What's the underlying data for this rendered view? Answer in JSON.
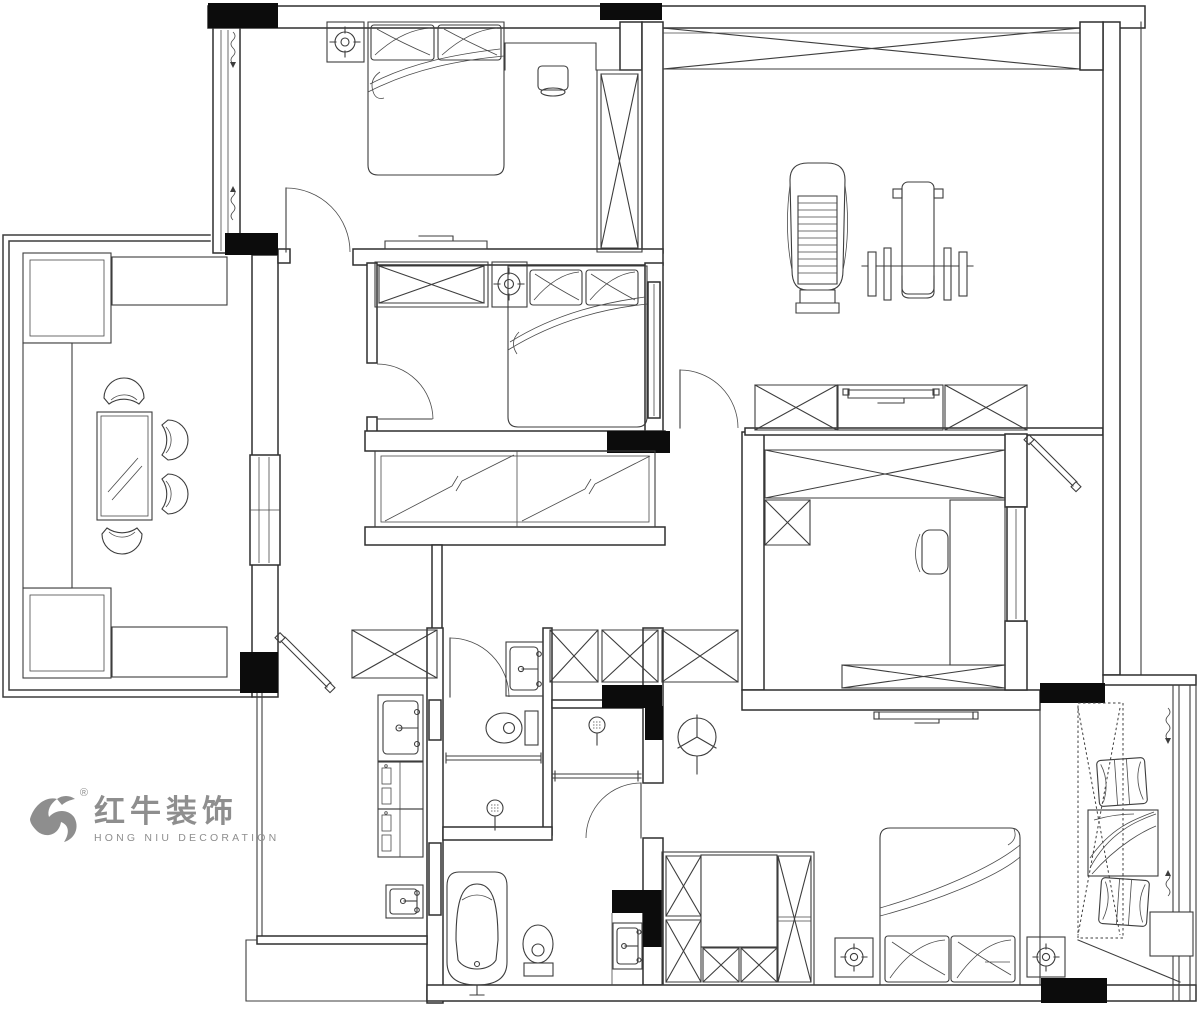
{
  "page": {
    "background": "#ffffff",
    "canvas_width": 1200,
    "canvas_height": 1009
  },
  "colors": {
    "line": "#3d3d3d",
    "wall": "#2f2f2f",
    "column_fill": "#0c0c0c",
    "logo_gray": "#8e8e8e"
  },
  "logo": {
    "brand_cn": "红牛装饰",
    "brand_en": "HONG NIU DECORATION",
    "trademark": "®"
  },
  "floorplan": {
    "type": "residential apartment CAD floor plan, black line work on white",
    "rooms": [
      {
        "id": "bedroom-1",
        "position": "top-left",
        "items": [
          "double bed with 2 pillows",
          "nightstand with ceiling-lamp symbol",
          "side cabinet with table lamp",
          "wardrobe with X symbol",
          "TV console on wall",
          "swing door",
          "window wall with curtain squiggles"
        ]
      },
      {
        "id": "gym",
        "position": "top-right",
        "items": [
          "treadmill",
          "weight bench machine",
          "long beam with cross brace"
        ]
      },
      {
        "id": "dining-balcony",
        "position": "left",
        "items": [
          "two L planters with shrub fill",
          "louver deck strips",
          "glass dining table",
          "four round-back chairs",
          "window wall"
        ]
      },
      {
        "id": "bedroom-2",
        "position": "center",
        "items": [
          "double bed with 2 pillows",
          "wardrobe with X symbol",
          "ceiling lamp box",
          "swing door",
          "side window"
        ]
      },
      {
        "id": "walk-in-closet",
        "position": "center",
        "items": [
          "sliding wardrobe with hanging-rod diagonals and Z breaks"
        ]
      },
      {
        "id": "entry-hall",
        "position": "center",
        "items": [
          "four X storage cabinets",
          "diagonal drying rod",
          "ceiling-fan symbol"
        ]
      },
      {
        "id": "kitchen",
        "position": "bottom-left",
        "items": [
          "sink with faucet",
          "two cooking/oven cabinet units",
          "prep sink",
          "pocket-door panels"
        ]
      },
      {
        "id": "bathroom-1",
        "position": "bottom-center",
        "items": [
          "swing door",
          "wash basin",
          "toilet",
          "glass screen",
          "floor drain"
        ]
      },
      {
        "id": "shower-room",
        "position": "bottom-center",
        "items": [
          "floor drain",
          "glass screen",
          "swing door"
        ]
      },
      {
        "id": "bathroom-2",
        "position": "bottom-center",
        "items": [
          "bathtub",
          "toilet",
          "wash basin in niche"
        ]
      },
      {
        "id": "study",
        "position": "right",
        "items": [
          "long desk",
          "office chair",
          "large X wardrobe",
          "small X cabinet",
          "TV shelf row",
          "sliding door",
          "diagonal coat rod"
        ]
      },
      {
        "id": "master-bedroom",
        "position": "bottom-right",
        "items": [
          "double bed with 2 pillows",
          "two nightstands with lamp symbols",
          "U wardrobe with dressing table",
          "wall TV",
          "ceiling-fan symbol"
        ]
      },
      {
        "id": "bay-window",
        "position": "right-edge",
        "items": [
          "window seat with dotted outline",
          "two decorative pillows",
          "throw cushion",
          "curtain squiggles",
          "exterior window"
        ]
      }
    ],
    "structure": {
      "black_columns": 9,
      "swing_doors": 6,
      "x_marked_storage_units": 13
    }
  }
}
